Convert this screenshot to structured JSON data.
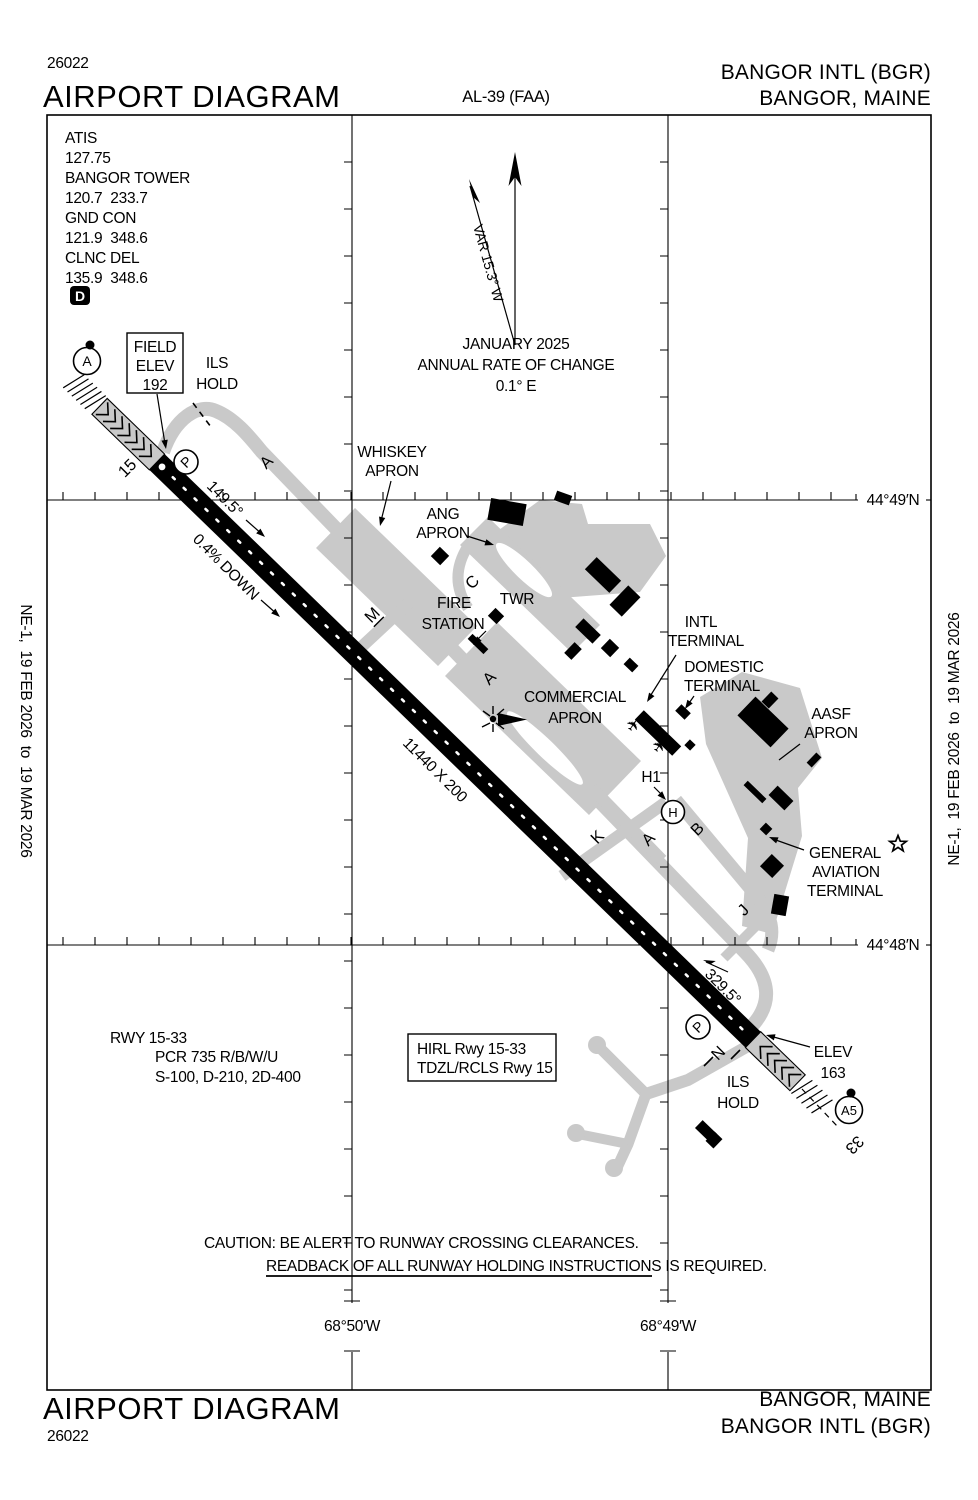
{
  "header": {
    "number": "26022",
    "title": "AIRPORT DIAGRAM",
    "al": "AL-39 (FAA)",
    "name": "BANGOR INTL (BGR)",
    "city": "BANGOR, MAINE"
  },
  "footer": {
    "title": "AIRPORT DIAGRAM",
    "number": "26022",
    "city": "BANGOR, MAINE",
    "name": "BANGOR INTL (BGR)"
  },
  "edge": {
    "text": "NE-1,  19 FEB 2026  to  19 MAR 2026"
  },
  "map": {
    "comm": [
      "ATIS",
      "127.75",
      "BANGOR TOWER",
      "120.7  233.7",
      "GND CON",
      "121.9  348.6",
      "CLNC DEL",
      "135.9  348.6"
    ],
    "d_symbol": "D",
    "north": {
      "var": "VAR 15.3° W",
      "date": "JANUARY 2025",
      "change": "ANNUAL RATE OF CHANGE",
      "rate": "0.1° E"
    },
    "field_elev": [
      "FIELD",
      "ELEV",
      "192"
    ],
    "ils_hold": [
      "ILS",
      "HOLD"
    ],
    "aprons": {
      "whiskey": [
        "WHISKEY",
        "APRON"
      ],
      "ang": [
        "ANG",
        "APRON"
      ],
      "fire": [
        "FIRE",
        "STATION"
      ],
      "twr": "TWR",
      "commercial": [
        "COMMERCIAL",
        "APRON"
      ],
      "intl": [
        "INTL",
        "TERMINAL"
      ],
      "domestic": [
        "DOMESTIC",
        "TERMINAL"
      ],
      "aasf": [
        "AASF",
        "APRON"
      ],
      "ga": [
        "GENERAL",
        "AVIATION",
        "TERMINAL"
      ]
    },
    "runway": {
      "rw15": "15",
      "rw33": "33",
      "hdg15": "149.5°",
      "hdg33": "329.5°",
      "slope": "0.4% DOWN",
      "size": "11440 X 200",
      "elev33": [
        "ELEV",
        "163"
      ]
    },
    "taxiways": {
      "a": "A",
      "b": "B",
      "c": "C",
      "j": "J",
      "k": "K",
      "m": "M",
      "n": "N"
    },
    "spots": {
      "p": "P",
      "a": "A",
      "a5": "A5",
      "h": "H",
      "h1": "H1"
    },
    "grid": {
      "lat1": "44°49′N",
      "lat2": "44°48′N",
      "lon1": "68°50′W",
      "lon2": "68°49′W"
    }
  },
  "notes": {
    "rwy": "RWY 15-33",
    "pcr": "PCR 735 R/B/W/U",
    "strength": "S-100, D-210, 2D-400",
    "light1": "HIRL Rwy 15-33",
    "light2": "TDZL/RCLS Rwy 15",
    "caution1": "CAUTION: BE ALERT TO RUNWAY CROSSING CLEARANCES.",
    "caution2": "READBACK OF ALL RUNWAY HOLDING INSTRUCTIONS IS REQUIRED."
  },
  "colors": {
    "pavement": "#c9c9c9",
    "ink": "#000000"
  }
}
